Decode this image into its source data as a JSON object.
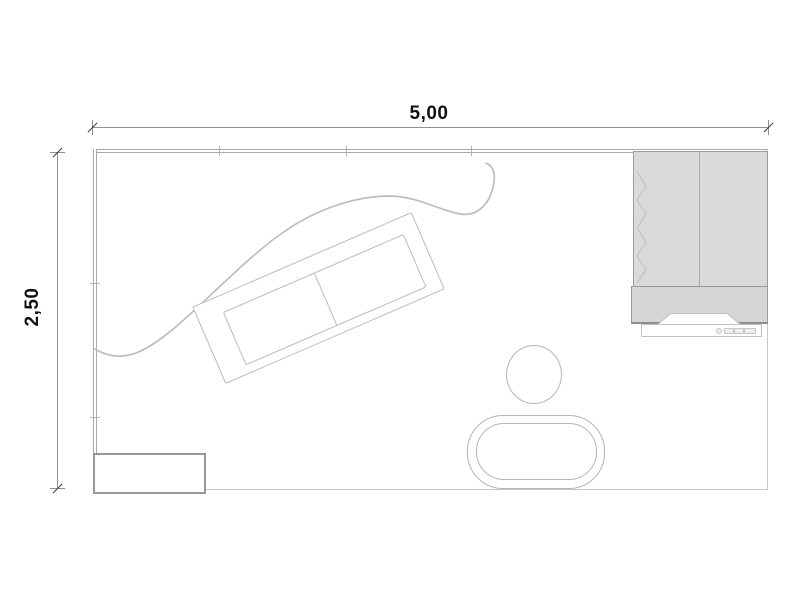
{
  "plan": {
    "type": "floor-plan-top-view",
    "dimensions": {
      "width_label": "5,00",
      "height_label": "2,50",
      "width_m": 5.0,
      "depth_m": 2.5
    },
    "furniture": [
      {
        "name": "sofa",
        "description": "two-seat sofa with two cushions, rotated diagonally"
      },
      {
        "name": "wardrobe",
        "description": "double-door wardrobe, grey fill, zigzag hinge marks on left edge"
      },
      {
        "name": "tv-cabinet",
        "description": "grey lowboard below wardrobe with trapezoid notch"
      },
      {
        "name": "tv-console",
        "description": "slim white media unit with small buttons"
      },
      {
        "name": "stool",
        "description": "round stool"
      },
      {
        "name": "coffee-table",
        "description": "oval table with double outline"
      },
      {
        "name": "sideboard",
        "description": "low rectangular cabinet in bottom-left corner"
      },
      {
        "name": "decor-curve",
        "description": "freeform S-curve line across the room"
      }
    ],
    "colors": {
      "wall": "#a9a9a9",
      "thin_wall": "#c9c9c9",
      "furniture_fill": "#dadada",
      "furniture_border": "#9b9b9b",
      "outline": "#bcbcbc",
      "dimension_line": "#8f8f8f",
      "dimension_text": "#111111",
      "background": "#ffffff"
    }
  }
}
